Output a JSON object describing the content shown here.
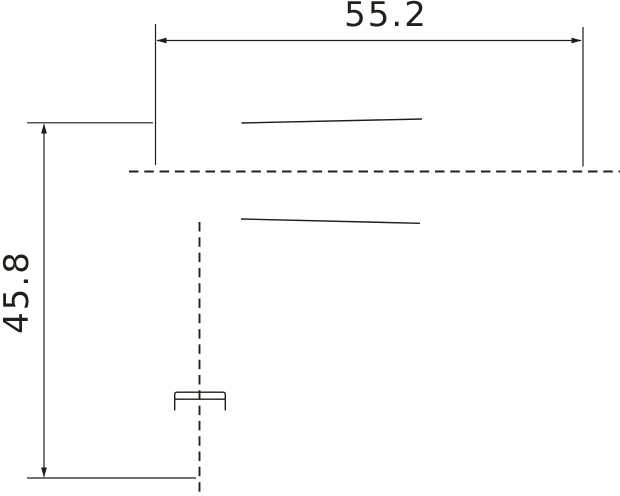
{
  "drawing": {
    "dimensions": {
      "width_label": "55.2",
      "height_label": "45.8"
    },
    "colors": {
      "background": "#ffffff",
      "line": "#201d17",
      "centerline": "#24221d",
      "text": "#211f1a"
    }
  }
}
